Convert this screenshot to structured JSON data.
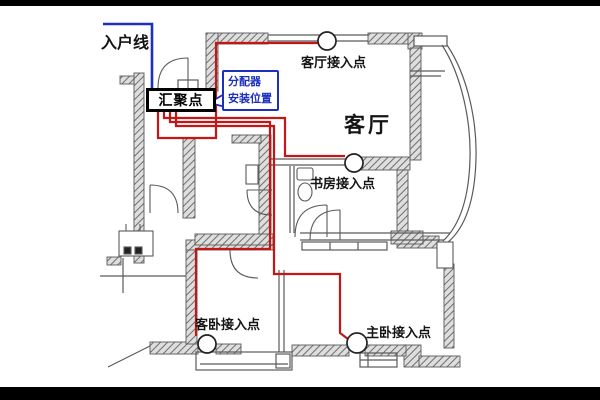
{
  "scene": {
    "description": "apartment floor plan with home-network cabling diagram"
  },
  "colors": {
    "cable_red": "#c41616",
    "entry_blue": "#1c2fbe",
    "wall_gray": "#5a5a5a",
    "background": "#ffffff",
    "letterbox": "#000000"
  },
  "labels": {
    "incoming_line": "入户线",
    "hub": "汇聚点",
    "distributor_l1": "分配器",
    "distributor_l2": "安装位置",
    "living_ap": "客厅接入点",
    "living_room": "客厅",
    "study_ap": "书房接入点",
    "guest_ap": "客卧接入点",
    "master_ap": "主卧接入点"
  },
  "access_points": [
    {
      "name": "living-room-access-point",
      "label": "客厅接入点"
    },
    {
      "name": "study-access-point",
      "label": "书房接入点"
    },
    {
      "name": "guest-bedroom-access-point",
      "label": "客卧接入点"
    },
    {
      "name": "master-bedroom-access-point",
      "label": "主卧接入点"
    }
  ]
}
